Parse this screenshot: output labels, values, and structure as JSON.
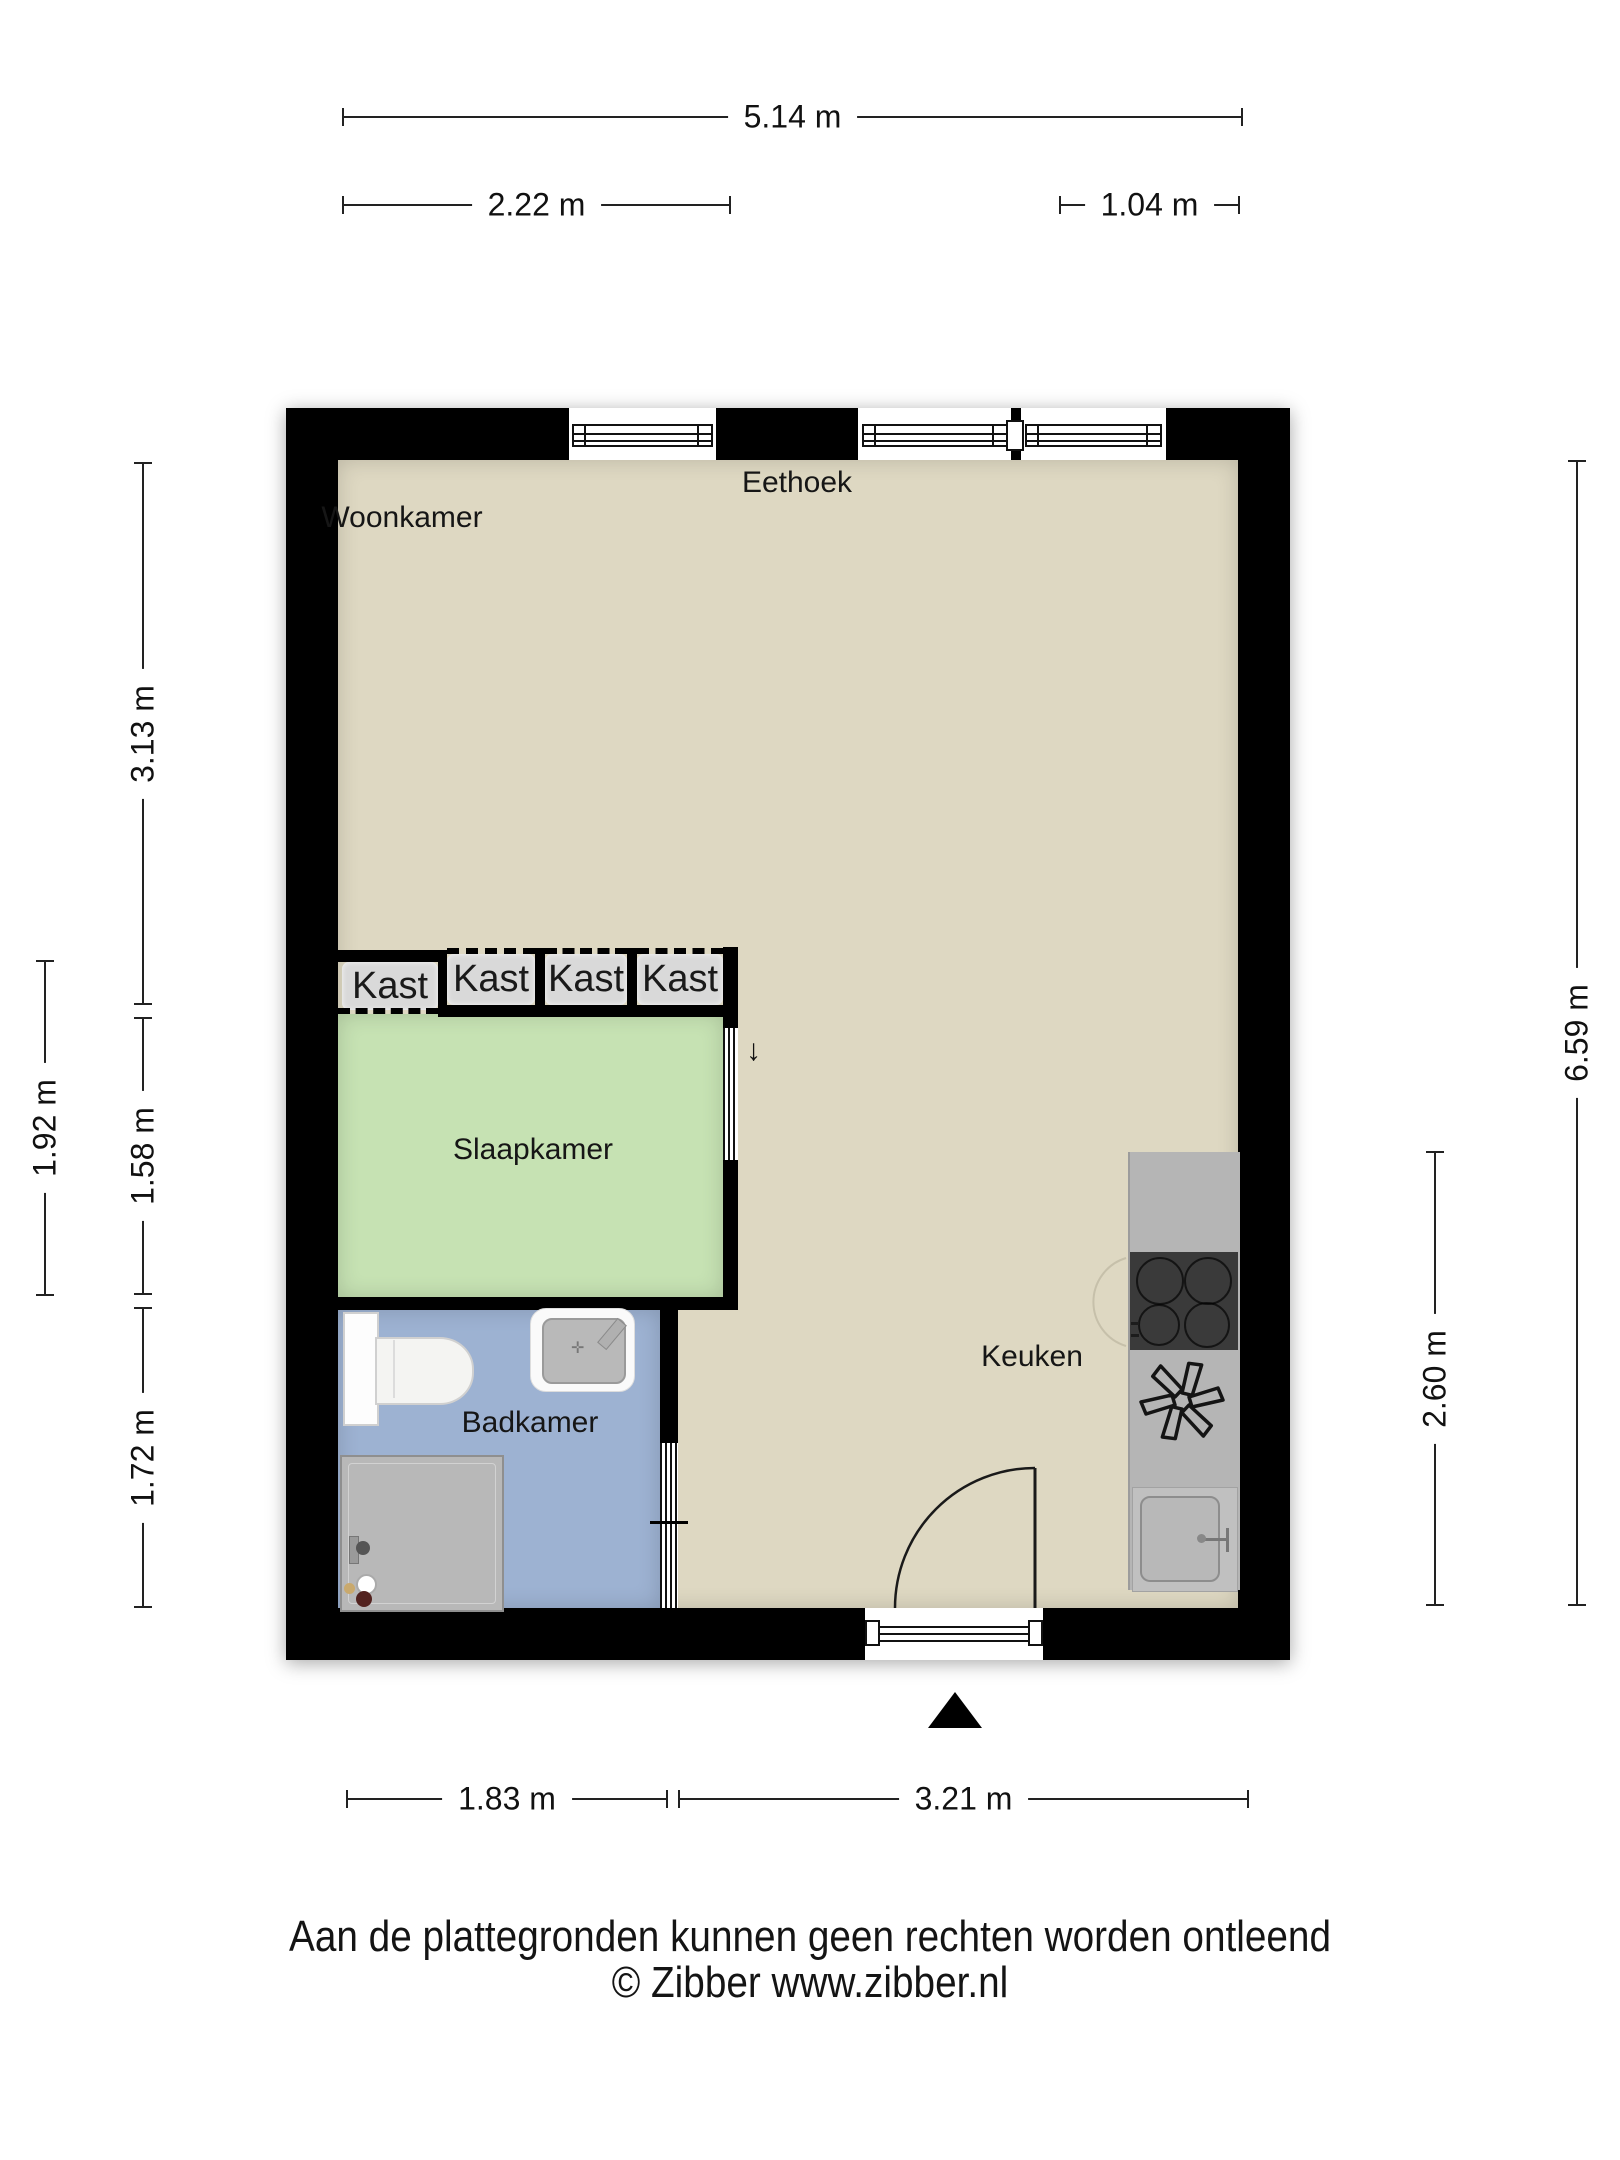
{
  "document": {
    "type": "floor-plan",
    "disclaimer": "Aan de plattegronden kunnen geen rechten worden ontleend",
    "copyright": "© Zibber www.zibber.nl"
  },
  "rooms": {
    "woonkamer": "Woonkamer",
    "eethoek": "Eethoek",
    "slaapkamer": "Slaapkamer",
    "badkamer": "Badkamer",
    "keuken": "Keuken",
    "kast": "Kast"
  },
  "dimensions": {
    "top_total": "5.14 m",
    "top_left_segment": "2.22 m",
    "top_right_segment": "1.04 m",
    "left_living": "3.13 m",
    "left_bedroom_outer": "1.92 m",
    "left_bedroom": "1.58 m",
    "left_bathroom": "1.72 m",
    "right_total": "6.59 m",
    "right_kitchen": "2.60 m",
    "bottom_left_segment": "1.83 m",
    "bottom_right_segment": "3.21 m"
  },
  "symbols": {
    "bedroom_door_arrow": "↓",
    "entrance_marker": "triangle-up"
  },
  "colors": {
    "wall": "#000000",
    "floor_living": "#ded8c2",
    "floor_bedroom": "#c6e2b3",
    "floor_bathroom": "#9db2d2",
    "closet_fill": "#d9d9d9",
    "counter": "#b5b5b5",
    "cooktop": "#3a3a3a"
  }
}
